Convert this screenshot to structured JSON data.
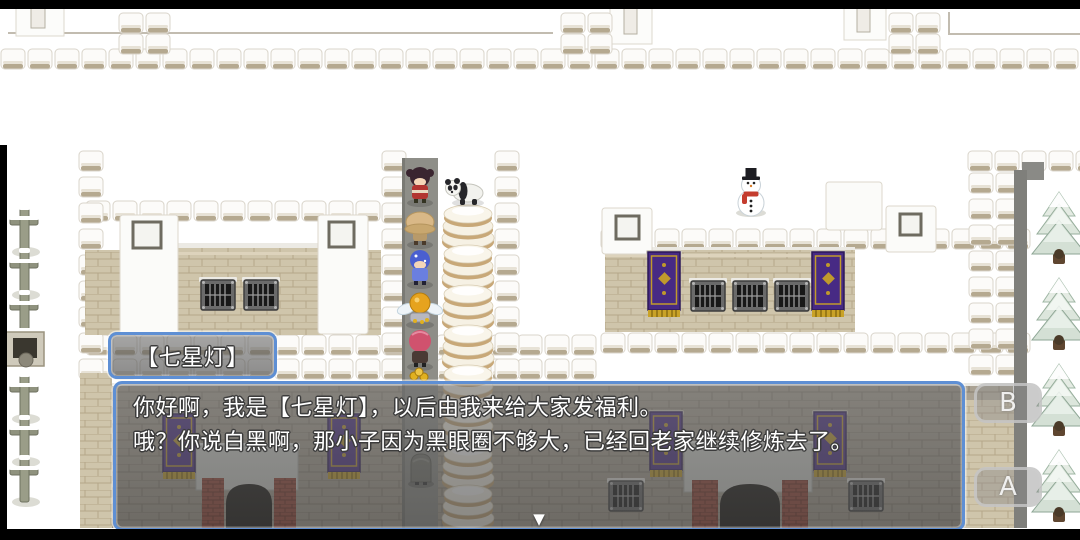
{
  "scene": {
    "dialogue": {
      "speaker_name": "【七星灯】",
      "line1": "你好啊，我是【七星灯】，以后由我来给大家发福利。",
      "line2": "哦？你说白黑啊，那小子因为黑眼圈不够大，已经回老家继续修炼去了。",
      "continue_indicator": "▼"
    },
    "touch_controls": {
      "b_label": "B",
      "a_label": "A"
    },
    "map_sprites": {
      "npc_column": [
        "dark-haired-girl",
        "panda",
        "straw-hat-figure",
        "blue-haired-figure",
        "winged-golden-idol",
        "pink-haired-figure",
        "treasure-pile",
        "gray-robed-figure"
      ],
      "decor": [
        "snowman",
        "bun-stack",
        "grave-cross",
        "stone-well",
        "snow-pine-tree",
        "purple-banner",
        "barred-window",
        "door-arch",
        "battlement-tiles"
      ]
    },
    "colors": {
      "dialog_border": "#5e8fd4",
      "dialog_fill": "rgba(90,90,90,0.6)",
      "banner_purple": "#472a84",
      "banner_gold": "#c9a227",
      "wall_tan": "#cfc5ab",
      "wall_gray": "#aaa293",
      "snow": "#ffffff",
      "letterbox": "#000000"
    }
  }
}
